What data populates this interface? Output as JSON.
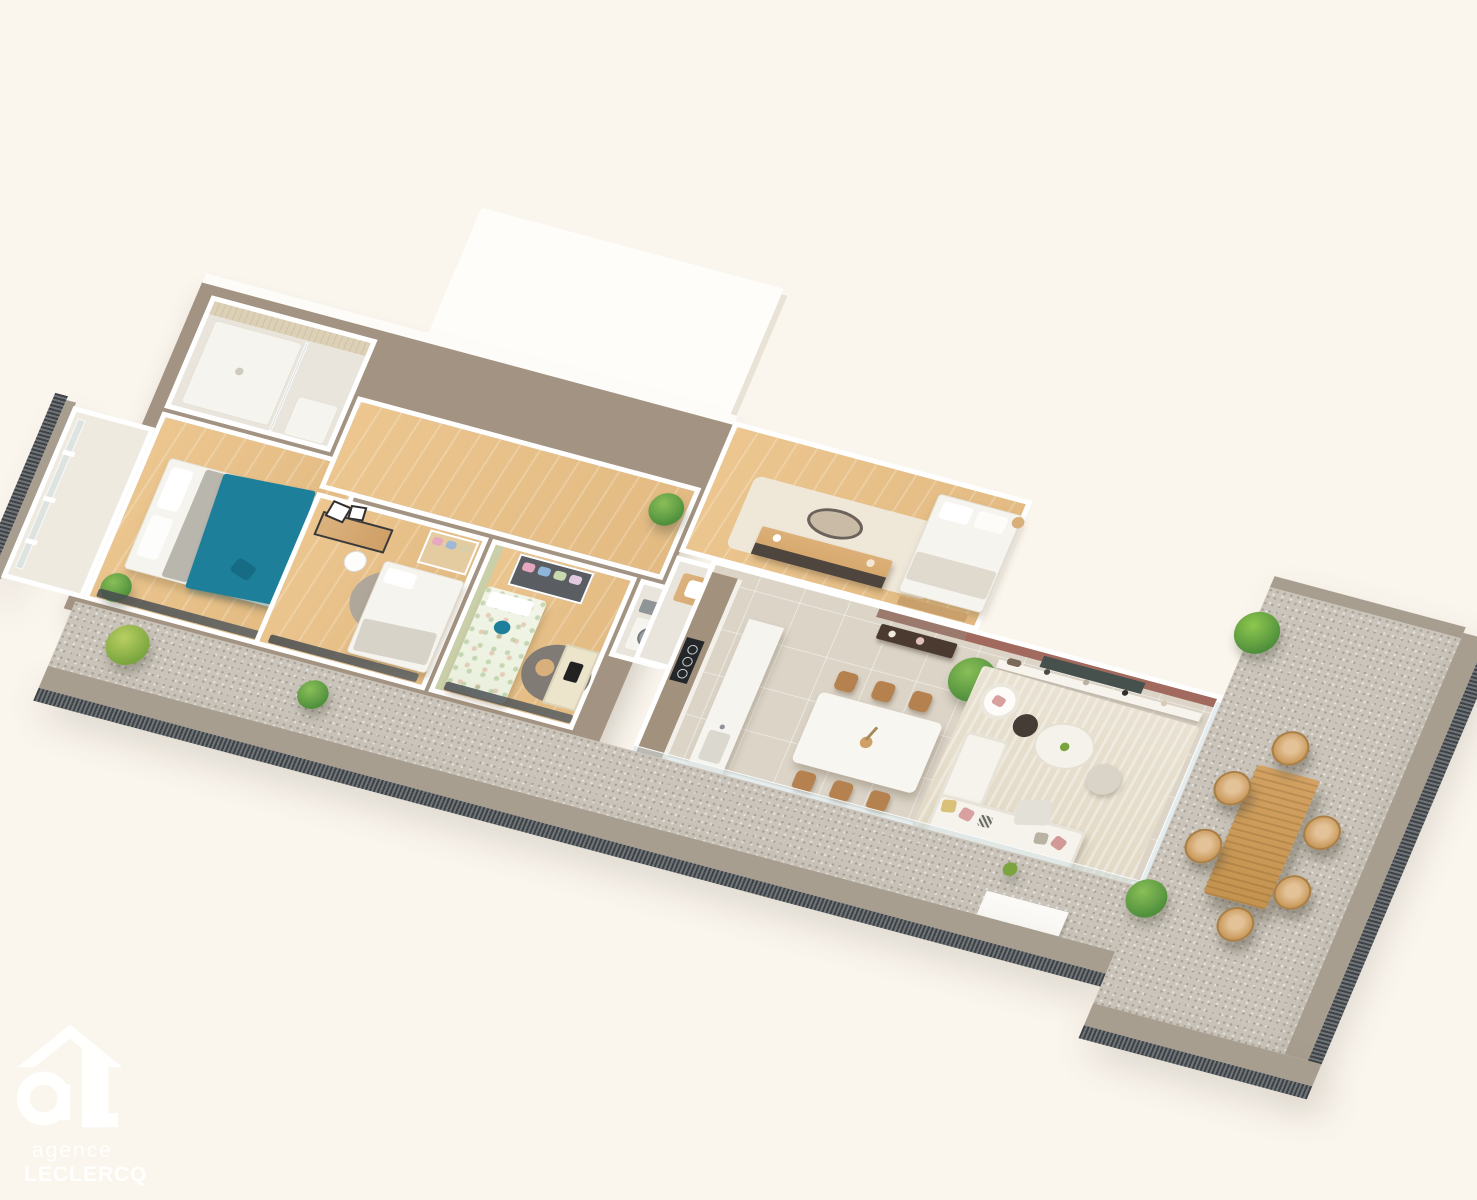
{
  "scene": {
    "type": "3d-isometric-floor-plan-render",
    "description": "Aerial 3D render of an apartment with three bedrooms plus master suite, open kitchen-living-dining area, bathrooms, a long balcony and a large gravel terrace with outdoor dining set",
    "background_color": "#faf5ed"
  },
  "watermark": {
    "icon": "agency-house-logo",
    "line1": "agence",
    "line2": "LECLERCQ"
  },
  "palette": {
    "bg": "#faf5ed",
    "wall-white": "#ffffff",
    "wall-taupe": "#a39382",
    "accent-terracotta": "#a2695e",
    "accent-mauve": "#9b7a6d",
    "accent-green": "#c9cfa8",
    "wood-floor": "#ecc countless",
    "wood-floor-dark": "#e2ba82",
    "tile-floor": "#dbd4c7",
    "gravel": "#cac4ba",
    "rim-taupe": "#a89e90",
    "corrugation": "#4e5254",
    "teal": "#1d7f99",
    "rattan": "#c9985a",
    "outdoor-wood": "#d3a263",
    "plant": "#4f8f3c",
    "plant-light": "#8abf58",
    "chair-wood": "#b5824f",
    "white-fixture": "#f6f4ee",
    "rug-beige": "#e9e1d1",
    "rug-grey": "#a9a49b",
    "dark-furniture": "#4a3a30",
    "black-appliance": "#24272a",
    "cushion-pink": "#d8a09e"
  },
  "apartment": {
    "rooms": [
      {
        "id": "shower-room",
        "name": "shower room",
        "floor": "tile",
        "items": [
          "walk-in shower",
          "glass screen",
          "mosaic wall",
          "vanity"
        ]
      },
      {
        "id": "bedroom-1",
        "name": "bedroom with teal bedding",
        "floor": "wood",
        "items": [
          "double bed",
          "teal throw",
          "white pillows",
          "wood stool",
          "potted plant",
          "floor-to-ceiling glazing"
        ]
      },
      {
        "id": "loggia",
        "name": "small loggia",
        "floor": "pale",
        "items": [
          "window frames"
        ]
      },
      {
        "id": "hallway",
        "name": "hallway",
        "floor": "wood",
        "items": [
          "potted plant"
        ]
      },
      {
        "id": "bedroom-2",
        "name": "bedroom with desk",
        "floor": "wood",
        "items": [
          "desk",
          "wall frames",
          "desk chair",
          "round grey rug",
          "double bed",
          "wardrobe with clothes"
        ]
      },
      {
        "id": "bedroom-3",
        "name": "kids bedroom",
        "floor": "wood",
        "items": [
          "green accent wall",
          "dark wardrobe with clothes",
          "single bed floral bedding",
          "teal cushion",
          "round dark rug",
          "desk",
          "chair"
        ]
      },
      {
        "id": "laundry",
        "name": "laundry closet",
        "floor": "pale",
        "items": [
          "washing machine",
          "towels"
        ]
      },
      {
        "id": "master-suite",
        "name": "master bedroom",
        "floor": "wood",
        "items": [
          "rug",
          "sideboard dresser",
          "oval wall mirror",
          "double bed",
          "foot bench",
          "side table"
        ]
      },
      {
        "id": "bathroom",
        "name": "bathroom",
        "floor": "pale",
        "items": [
          "wood vanity with basin",
          "bathtub"
        ]
      },
      {
        "id": "wc",
        "name": "toilet room",
        "floor": "pale",
        "items": [
          "toilet"
        ]
      },
      {
        "id": "living-kitchen",
        "name": "open kitchen / dining / living",
        "floor": "tile",
        "items": [
          "mauve entry wall",
          "entry console with candle and flowers",
          "terracotta accent wall",
          "wall TV",
          "media shelf with books and decor",
          "monstera plant",
          "kitchen cabinets",
          "induction hob",
          "kitchen island with sink",
          "white dining table",
          "6 wood dining chairs",
          "beige rug",
          "white armchair with pink cushion",
          "dark side table",
          "round white coffee table",
          "pouf",
          "L-shaped white sofa",
          "pink grey and mustard cushions",
          "glass wall to terrace"
        ]
      }
    ],
    "outdoor": [
      {
        "id": "balcony",
        "name": "balcony strip",
        "surface": "gravel",
        "items": [
          "potted shrubs",
          "taupe parapet rim",
          "corrugated edge",
          "white parapet block"
        ]
      },
      {
        "id": "terrace",
        "name": "large terrace",
        "surface": "gravel",
        "items": [
          "outdoor wood dining table",
          "6 rattan chairs",
          "potted bushes",
          "taupe rim",
          "corrugated dark edging",
          "glass balustrade"
        ]
      }
    ]
  }
}
